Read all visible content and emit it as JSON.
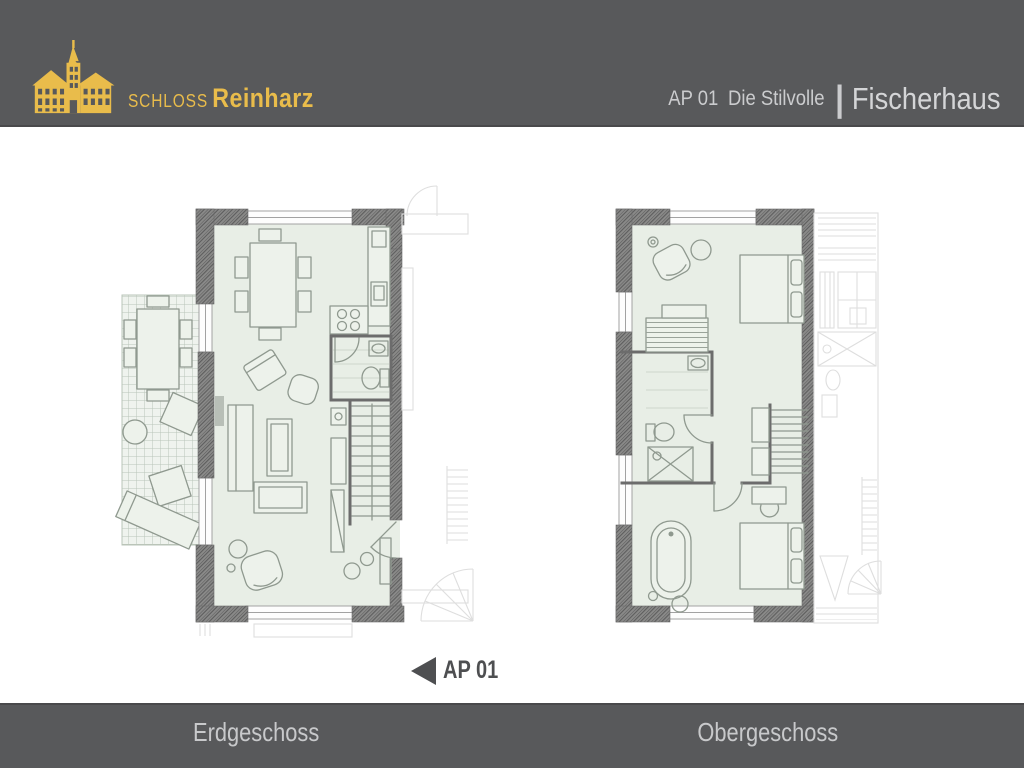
{
  "header": {
    "brand": {
      "icon": "castle-logo-icon",
      "prefix": "SCHLOSS",
      "name": "Reinharz"
    },
    "unit_code": "AP 01",
    "unit_name": "Die Stilvolle",
    "separator": "|",
    "building_name": "Fischerhaus"
  },
  "marker": {
    "icon": "left-arrow-icon",
    "label": "AP 01"
  },
  "plans": {
    "left_plan": "Erdgeschoss",
    "right_plan": "Obergeschoss"
  },
  "footer": {
    "left_label": "Erdgeschoss",
    "right_label": "Obergeschoss"
  },
  "colors": {
    "header_bg": "#58595B",
    "brand_gold": "#E9BC4B",
    "header_text": "#CBCCCE",
    "building_text": "#D4D5D7",
    "footer_text": "#C8C9CB",
    "marker_color": "#4E4F51",
    "divider_line": "#49494B",
    "plan_fill": "#E8EEE6",
    "wall_color": "#7C7C7C",
    "furniture_line": "#8F998F",
    "terrace_line": "#B9C4B8",
    "faded_line": "#DEDEDE"
  }
}
